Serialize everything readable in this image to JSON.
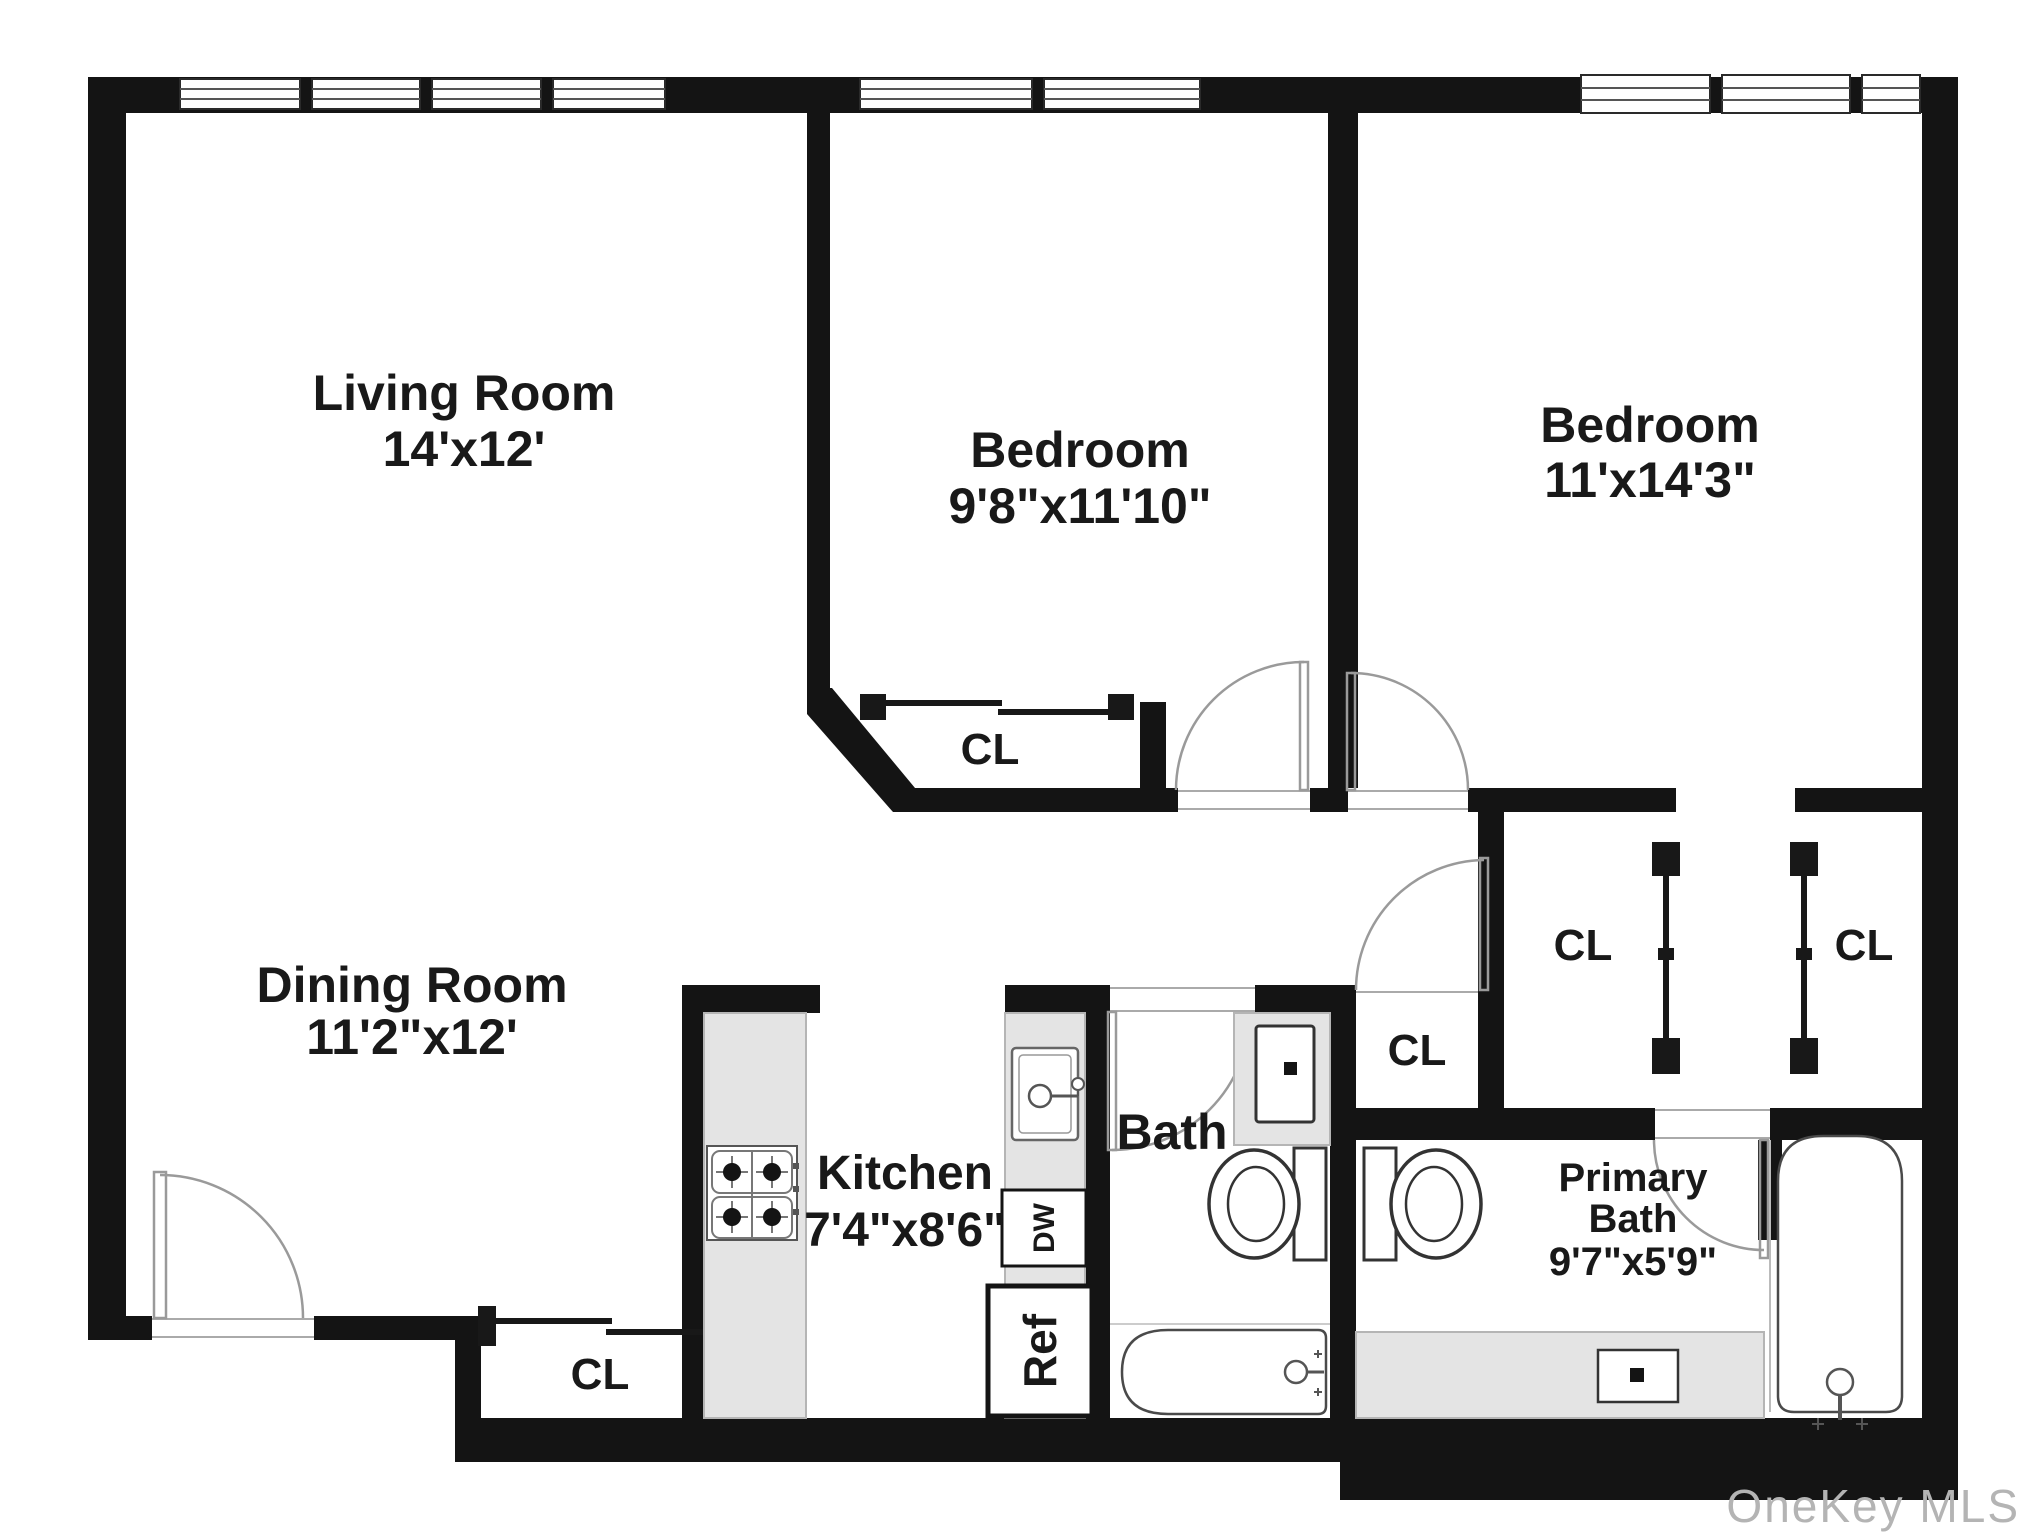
{
  "rooms": {
    "living_room": {
      "label": "Living Room",
      "dims": "14'x12'"
    },
    "bedroom_1": {
      "label": "Bedroom",
      "dims": "9'8\"x11'10\""
    },
    "bedroom_2": {
      "label": "Bedroom",
      "dims": "11'x14'3\""
    },
    "dining_room": {
      "label": "Dining Room",
      "dims": "11'2\"x12'"
    },
    "kitchen": {
      "label": "Kitchen",
      "dims": "7'4\"x8'6\""
    },
    "bath": {
      "label": "Bath"
    },
    "primary_bath": {
      "label_line1": "Primary",
      "label_line2": "Bath",
      "dims": "9'7\"x5'9\""
    }
  },
  "closet_label": "CL",
  "appliances": {
    "refrigerator": "Ref",
    "dishwasher": "DW"
  },
  "watermark": "OneKey MLS",
  "colors": {
    "wall": "#141414",
    "counter": "#e4e4e4",
    "fixture_line": "#4a4a4a",
    "door_line": "#9a9a9a",
    "label": "#191919",
    "watermark": "#b4b4b4",
    "background": "#ffffff"
  }
}
